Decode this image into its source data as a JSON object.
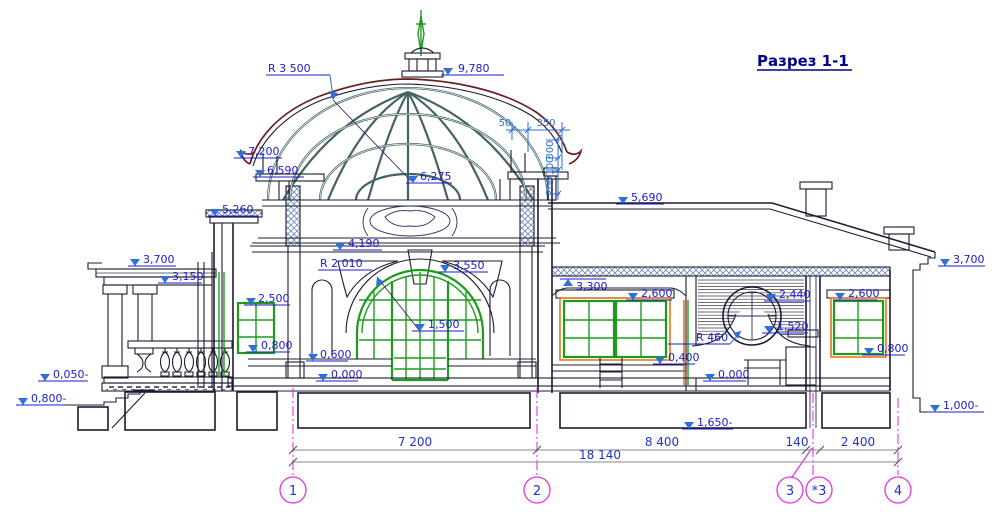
{
  "title": "Разрез 1-1",
  "colors": {
    "label_blue": "#1b1bcf",
    "dim_blue": "#2e6fd8",
    "magenta": "#e833e8",
    "green": "#1e9b1e",
    "orange": "#e07820",
    "dome_red": "#6b2020",
    "ink": "#1c1c30",
    "glazing": "#456363",
    "title_navy": "#00008c"
  },
  "elevations": {
    "dome_top": "9,780",
    "dome_radius": "R 3 500",
    "eave": "7,200",
    "cornice_6590": "6,590",
    "cornice_5260": "5,260",
    "dome_inner": "6,275",
    "hall_wall_top": "4,190",
    "arch_radius": "R 2 010",
    "arch_top": "3,550",
    "arch_center": "1,500",
    "portico_top": "3,700",
    "portico_beam": "3,150",
    "left_window_top": "2,500",
    "left_window_sill": "0,800",
    "hall_floor_step": "0,600",
    "hall_floor": "0,000",
    "terrace": "0,050-",
    "ground_left": "0,800-",
    "wing_roof": "5,690",
    "wing_ceiling": "3,300",
    "wing_window_top": "2,600",
    "louver_top": "2,440",
    "round_window_radius": "R 460",
    "ledge": "1,520",
    "wing_dado": "0,400",
    "wing_floor": "0,000",
    "right_window_top": "2,600",
    "right_window_sill": "0,800",
    "right_cornice": "3,700",
    "footing_right": "1,000-",
    "foundation_bottom": "1,650-"
  },
  "detail_dims": {
    "d50": "50",
    "d350": "350",
    "v300": "300",
    "v100": "100",
    "v200": "200"
  },
  "bottom_dims": {
    "seg_1_2": "7 200",
    "seg_2_3": "8 400",
    "seg_3_3a": "140",
    "seg_3a_4": "2 400",
    "total": "18 140"
  },
  "axes": {
    "a1": "1",
    "a2": "2",
    "a3": "3",
    "a3a": "*3",
    "a4": "4"
  }
}
